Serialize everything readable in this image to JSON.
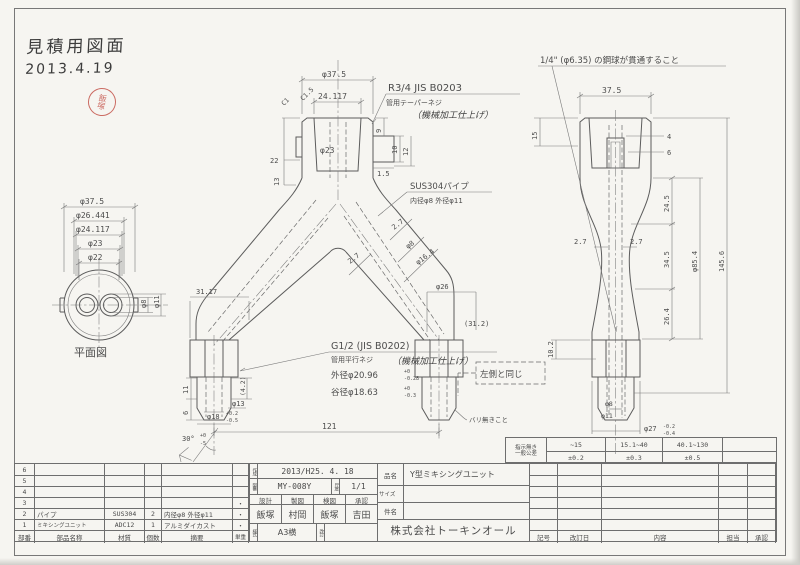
{
  "note": {
    "title": "見積用図面",
    "date": "2013.4.19",
    "stamp": "飯塚"
  },
  "plan_view": {
    "label": "平面図",
    "d375": "φ37.5",
    "d26441": "φ26.441",
    "d24117": "φ24.117",
    "d23": "φ23",
    "d22": "φ22",
    "d8": "φ8",
    "d11": "φ11"
  },
  "front_view": {
    "d375": "φ37.5",
    "d24117": "24.117",
    "d23": "φ23",
    "chamfer_a": "C1",
    "chamfer_b": "C1.5",
    "d9": "9",
    "d10": "10",
    "d12": "12",
    "d15": "1.5",
    "d22": "22",
    "d13": "13",
    "d3117": "31.17",
    "d312": "(31.2)",
    "d26": "φ26",
    "wall_a": "2.7",
    "wall_b": "2.7",
    "d8": "φ8",
    "d164": "φ16.4",
    "r_note1": "R3/4 JIS B0203",
    "r_note2": "管用テーパーネジ",
    "r_note3": "（機械加工仕上げ）",
    "pipe_note1": "SUS304パイプ",
    "pipe_note2": "内径φ8 外径φ11",
    "g_note1": "G1/2 (JIS B0202)",
    "g_note2": "管用平行ネジ",
    "g_note2b": "（機械加工仕上げ）",
    "g_od": "外径φ20.96",
    "g_od_hi": "+0",
    "g_od_lo": "-0.28",
    "g_root": "谷径φ18.63",
    "g_root_hi": "+0",
    "g_root_lo": "-0.3",
    "d11len": "11",
    "d6": "6",
    "d42": "(4.2)",
    "d13dia": "φ13",
    "d18": "φ18",
    "d18_hi": "+0.2",
    "d18_lo": "-0.5",
    "angle": "30°",
    "angle_hi": "+0",
    "angle_lo": "-5",
    "overall": "121",
    "same_as_left": "左側と同じ",
    "no_burr": "バリ無きこと"
  },
  "side_view": {
    "ball_note": "1/4\" (φ6.35) の鋼球が貫通すること",
    "d375": "37.5",
    "d15": "15",
    "d4": "4",
    "d6": "6",
    "wall_a": "2.7",
    "wall_b": "2.7",
    "d245": "24.5",
    "d345": "34.5",
    "d264": "26.4",
    "d854": "φ85.4",
    "d1456": "145.6",
    "d102": "10.2",
    "d8": "φ8",
    "d11": "φ11",
    "d27": "φ27",
    "d27_hi": "-0.2",
    "d27_lo": "-0.4"
  },
  "tolerance_table": {
    "label_line1": "指示無き",
    "label_line2": "一般公差",
    "ranges": [
      "~15",
      "15.1~40",
      "40.1~130"
    ],
    "values": [
      "±0.2",
      "±0.3",
      "±0.5"
    ]
  },
  "parts_table": {
    "headers": {
      "no": "部番",
      "name": "部品名称",
      "material": "材質",
      "qty": "個数",
      "note": "摘要",
      "weight": "単重"
    },
    "rows": [
      {
        "no": "6",
        "name": "",
        "material": "",
        "qty": "",
        "note": "",
        "weight": ""
      },
      {
        "no": "5",
        "name": "",
        "material": "",
        "qty": "",
        "note": "",
        "weight": ""
      },
      {
        "no": "4",
        "name": "",
        "material": "",
        "qty": "",
        "note": "",
        "weight": ""
      },
      {
        "no": "3",
        "name": "",
        "material": "",
        "qty": "",
        "note": "",
        "weight": "・"
      },
      {
        "no": "2",
        "name": "パイプ",
        "material": "SUS304",
        "qty": "2",
        "note": "内径φ8 外径φ11",
        "weight": "・"
      },
      {
        "no": "1",
        "name": "ミキシングユニット",
        "material": "ADC12",
        "qty": "1",
        "note": "アルミダイカスト",
        "weight": "・"
      }
    ]
  },
  "title_block": {
    "date_label": "作成",
    "date": "2013/H25. 4. 18",
    "dwg_no_label": "図番",
    "dwg_no": "MY-008Y",
    "scale_label": "尺度",
    "scale": "1/1",
    "role_headers": [
      "設計",
      "製図",
      "検図",
      "承認"
    ],
    "role_names": [
      "飯塚",
      "村岡",
      "飯塚",
      "吉田"
    ],
    "format_label": "様式",
    "format": "A3横",
    "rev_label": "改訂",
    "part_label": "品名",
    "part_name": "Y型ミキシングユニット",
    "size_label": "サイズ",
    "size": "",
    "subject_label": "件名",
    "subject": "",
    "company": "株式会社トーキンオール"
  },
  "revision_table": {
    "headers": [
      "記号",
      "改訂日",
      "内容",
      "担当",
      "承認"
    ]
  }
}
